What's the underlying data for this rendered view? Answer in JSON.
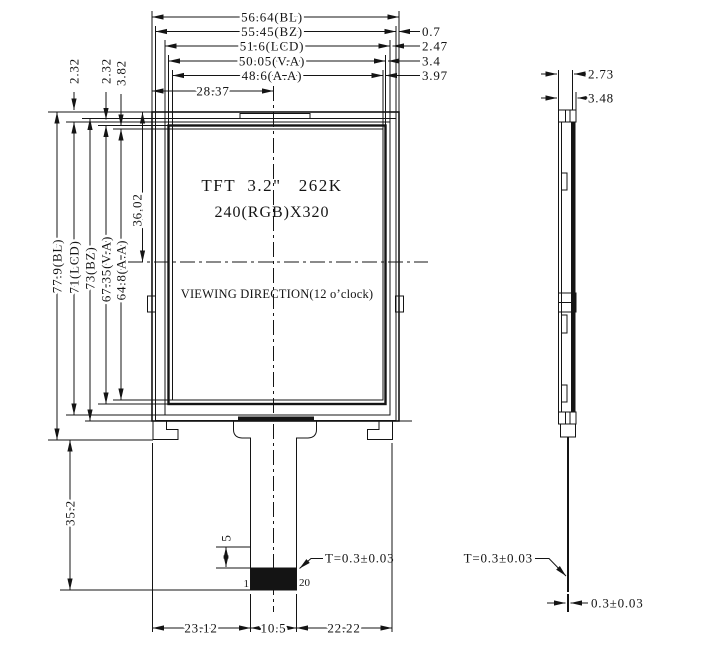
{
  "front_view": {
    "display_title": "TFT  3.2\"   262K",
    "display_subtitle": "240(RGB)X320",
    "viewing_direction": "VIEWING DIRECTION(12 o’clock)",
    "pin_first_label": "1",
    "pin_last_label": "20",
    "fpc_thickness_note": "T=0.3±0.03"
  },
  "side_view": {
    "thickness_dims": [
      "2.73",
      "3.48"
    ],
    "fpc_thickness_note": "T=0.3±0.03",
    "fpc_thickness_dim": "0.3±0.03"
  },
  "dims": {
    "top": [
      "56.64(BL)",
      "55.45(BZ)",
      "51.6(LCD)",
      "50.05(V.A)",
      "48.6(A.A)"
    ],
    "top_center": "28.37",
    "top_right": [
      "0.7",
      "2.47",
      "3.4",
      "3.97"
    ],
    "left": [
      "77.9(BL)",
      "71(LCD)",
      "73(BZ)",
      "67.35(V.A)",
      "64.8(A.A)"
    ],
    "top_left": [
      "2.32",
      "2.32",
      "3.82"
    ],
    "screen_center": "36.02",
    "tail": "35.2",
    "stiffener": "5",
    "bottom": [
      "23.12",
      "10.5",
      "22.22"
    ]
  }
}
